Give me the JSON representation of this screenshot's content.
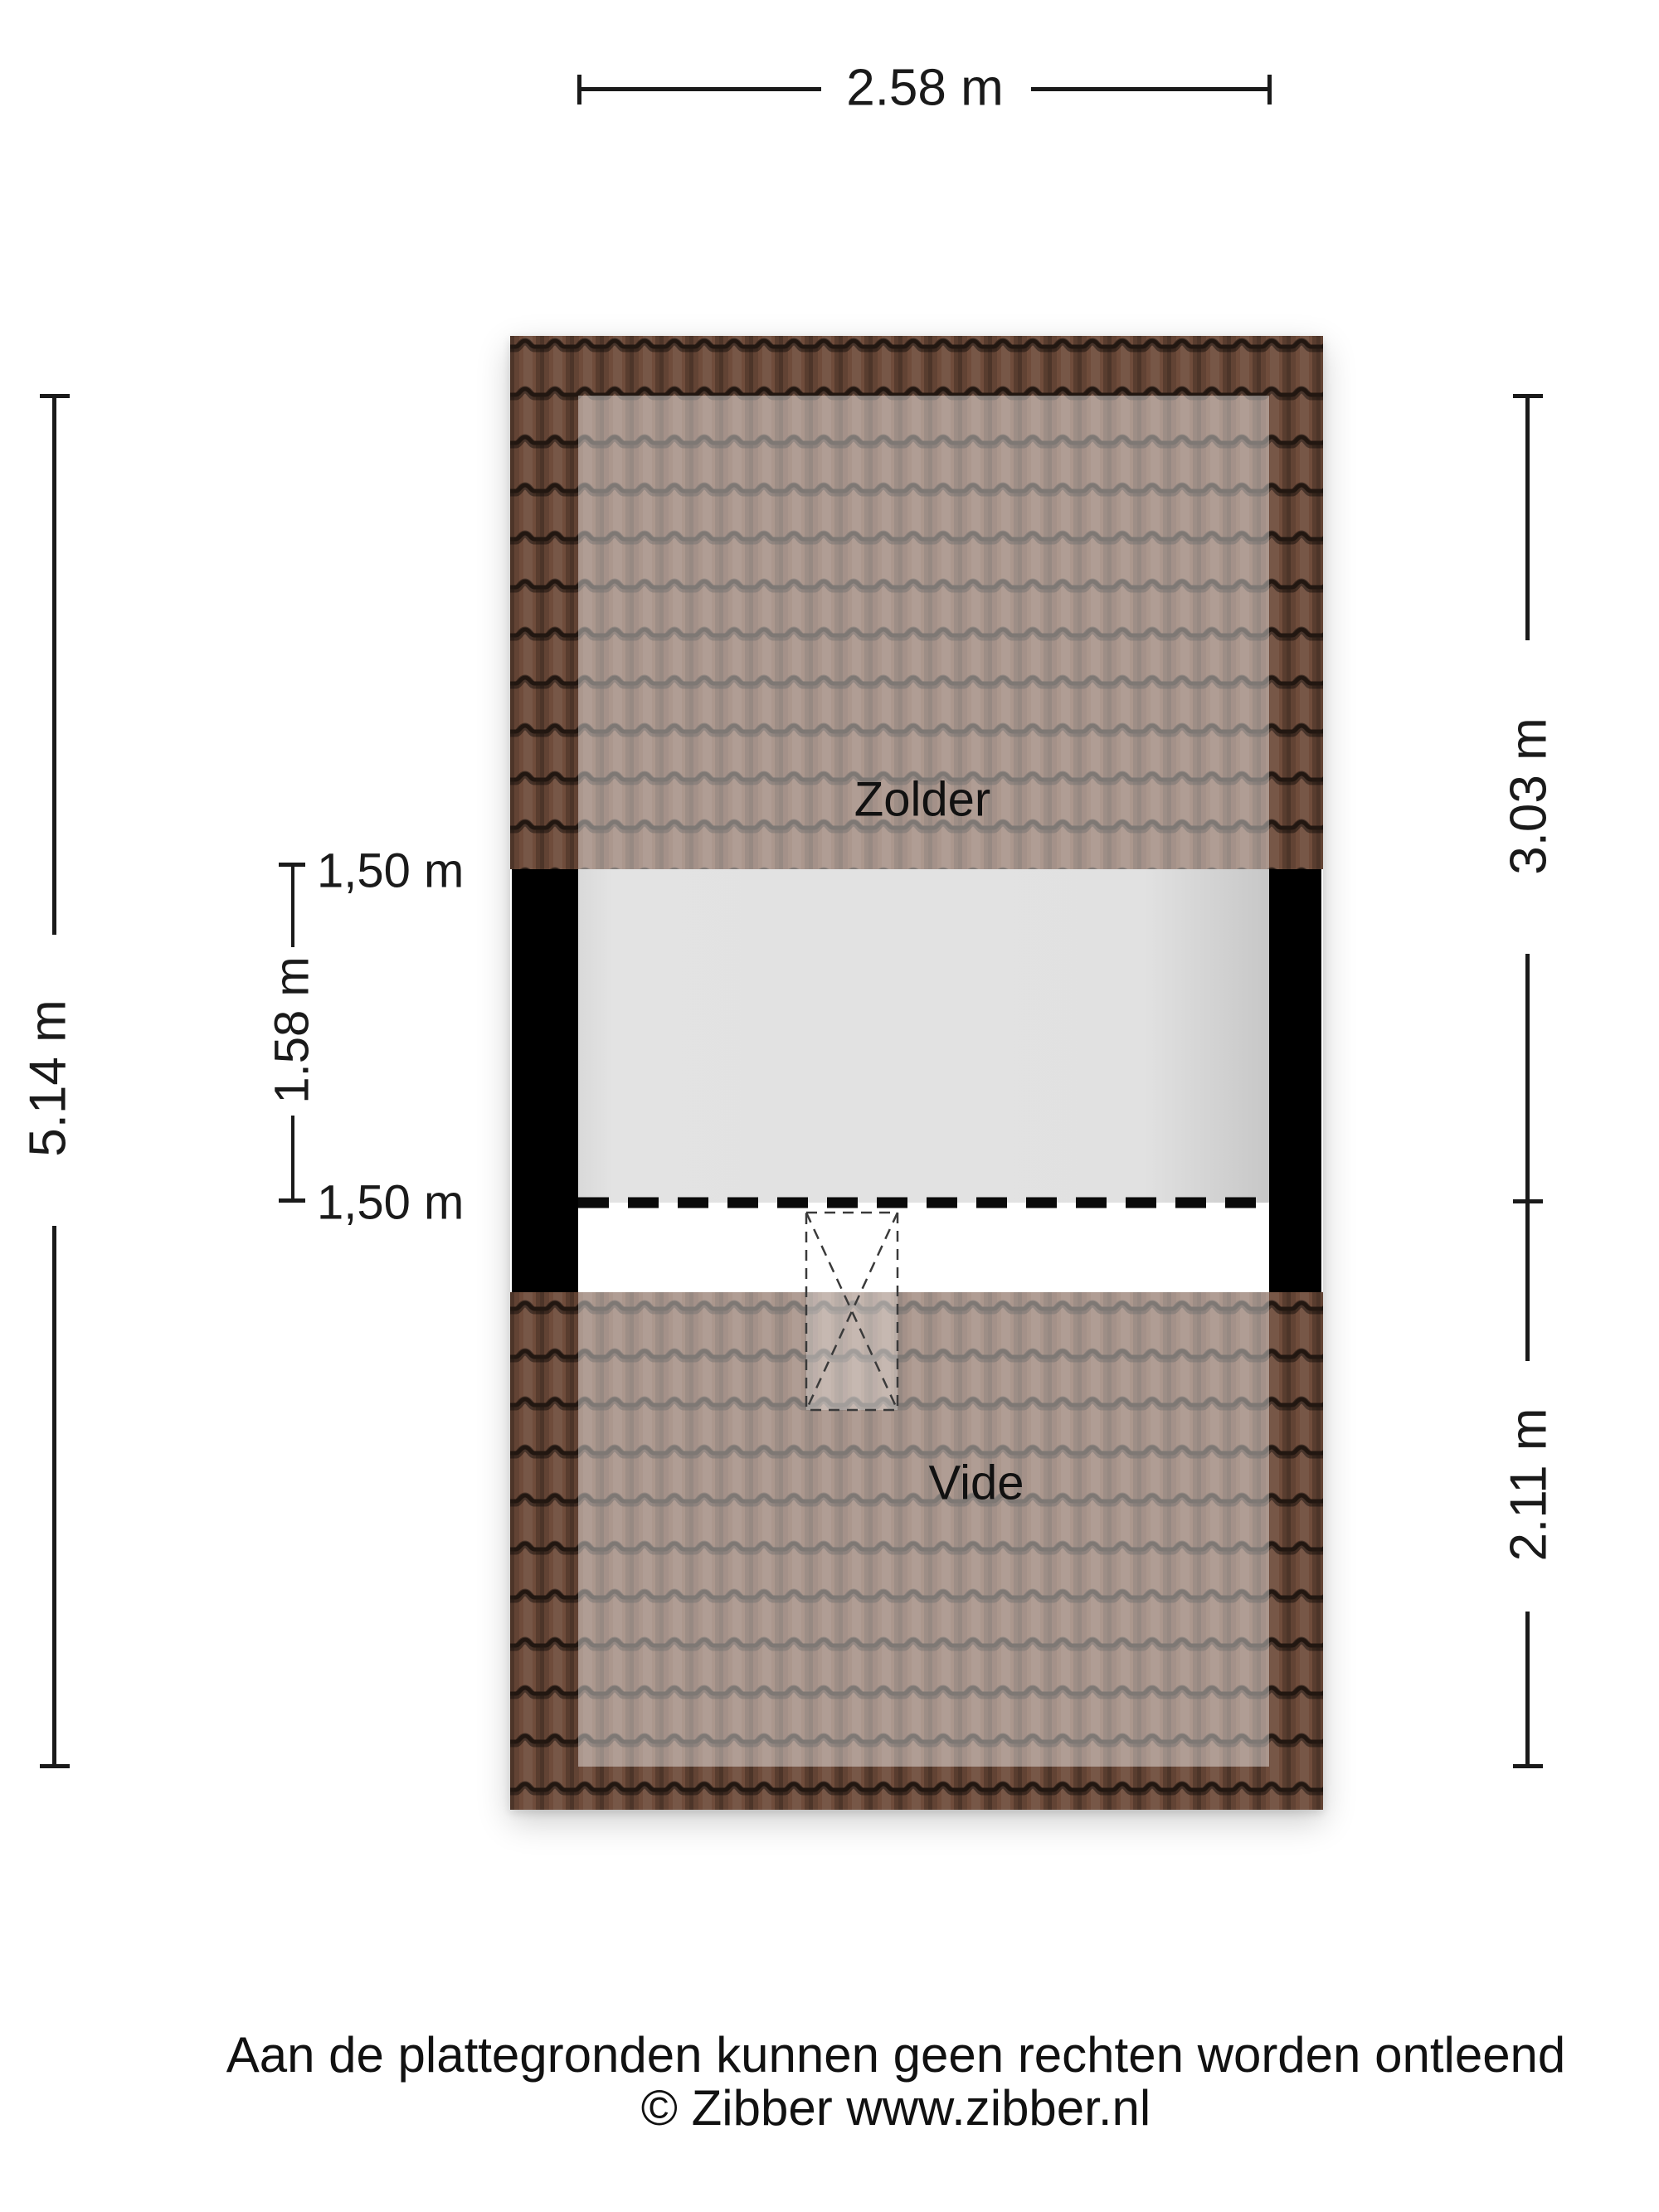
{
  "plan": {
    "rooms": [
      {
        "label": "Zolder"
      },
      {
        "label": "Vide"
      }
    ],
    "dimensions": {
      "width_top": "2.58 m",
      "height_left": "5.14 m",
      "height_right_top": "3.03 m",
      "height_right_bottom": "2.11 m",
      "inner_height": "1.58 m",
      "headroom_line_top": "1,50 m",
      "headroom_line_bottom": "1,50 m"
    },
    "colors": {
      "roof_tile": "#6f4c3b",
      "roof_tile_line": "#221711",
      "wall": "#000000",
      "floor": "#e2e2e2",
      "dashed_line": "#0a0a0a",
      "background": "#ffffff"
    }
  },
  "footer": {
    "disclaimer": "Aan de plattegronden kunnen geen rechten worden ontleend",
    "copyright": "© Zibber www.zibber.nl"
  }
}
